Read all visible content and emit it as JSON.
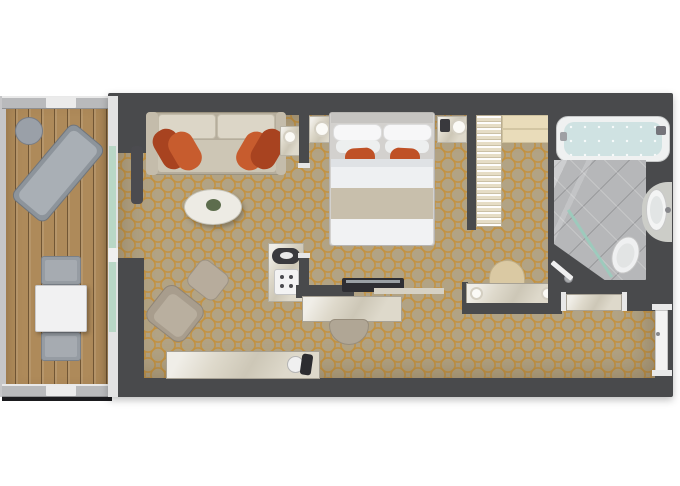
{
  "canvas": {
    "width": 680,
    "height": 486,
    "background": "#ffffff"
  },
  "palette": {
    "wall": "#494a4c",
    "carpet_base": "#b2a384",
    "carpet_lattice": "#c4913c",
    "deck_wood": "#ae8a5a",
    "marble": "#ded9cb",
    "accent_orange_dark": "#a84320",
    "accent_orange_light": "#c75c2e",
    "glass_green": "#b9d7c6",
    "bath_tile": "#b6b7b9",
    "tub_water": "#cfe2e2",
    "linen_white": "#f1f2f3"
  },
  "rooms": [
    {
      "name": "balcony"
    },
    {
      "name": "living-room"
    },
    {
      "name": "bedroom"
    },
    {
      "name": "closet"
    },
    {
      "name": "vanity-corridor"
    },
    {
      "name": "bathroom"
    },
    {
      "name": "entry"
    }
  ],
  "elements": [
    {
      "name": "balcony-deck",
      "cls": "deck",
      "x": 2,
      "y": 96,
      "w": 108,
      "h": 301
    },
    {
      "name": "balcony-left-rail",
      "x": 0,
      "y": 96,
      "w": 6,
      "h": 301,
      "fill": "#c6c6c8"
    },
    {
      "name": "balcony-top-rail",
      "cls": "rail",
      "x": 2,
      "y": 96,
      "w": 108,
      "h": 13
    },
    {
      "name": "balcony-top-rail-panel",
      "x": 46,
      "y": 97,
      "w": 30,
      "h": 11,
      "fill": "#ebebeb",
      "radius": 1
    },
    {
      "name": "balcony-bottom-rail",
      "cls": "rail",
      "x": 2,
      "y": 384,
      "w": 108,
      "h": 13
    },
    {
      "name": "balcony-bottom-rail-panel",
      "x": 46,
      "y": 385,
      "w": 30,
      "h": 11,
      "fill": "#ebebeb",
      "radius": 1
    },
    {
      "name": "balcony-shadow",
      "x": 2,
      "y": 397,
      "w": 110,
      "h": 4,
      "fill": "#1b1b1e"
    },
    {
      "name": "balcony-side-table",
      "x": 15,
      "y": 117,
      "w": 28,
      "h": 28,
      "fill": "#9aa0a8",
      "radius": "50%",
      "border": "1px solid #787d86"
    },
    {
      "name": "lounger-frame",
      "x": 36,
      "y": 124,
      "w": 44,
      "h": 98,
      "fill": "#8d949b",
      "radius": 8,
      "rotate": 40,
      "border": "1px solid #6f757c"
    },
    {
      "name": "lounger-pad",
      "x": 41,
      "y": 129,
      "w": 34,
      "h": 88,
      "fill": "#a9afb5",
      "radius": 6,
      "rotate": 40
    },
    {
      "name": "dining-chair-top",
      "x": 41,
      "y": 256,
      "w": 40,
      "h": 29,
      "fill": "#969ca3",
      "radius": 3,
      "border": "1px solid #7a8088"
    },
    {
      "name": "dining-chair-top-pad",
      "x": 45,
      "y": 260,
      "w": 32,
      "h": 21,
      "fill": "#a6abb1",
      "radius": 2
    },
    {
      "name": "dining-chair-bottom",
      "x": 41,
      "y": 332,
      "w": 40,
      "h": 29,
      "fill": "#969ca3",
      "radius": 3,
      "border": "1px solid #7a8088"
    },
    {
      "name": "dining-chair-bottom-pad",
      "x": 45,
      "y": 336,
      "w": 32,
      "h": 21,
      "fill": "#a6abb1",
      "radius": 2
    },
    {
      "name": "dining-table",
      "x": 35,
      "y": 285,
      "w": 52,
      "h": 47,
      "fill": "#f1f1f2",
      "radius": 2,
      "border": "1px solid #c9c9cb",
      "shadow": "2px 2px 4px rgba(0,0,0,.3)"
    },
    {
      "name": "suite-walls",
      "x": 108,
      "y": 93,
      "w": 565,
      "h": 304,
      "fill": "#494a4c",
      "radius": 2,
      "shadow": "0 3px 8px rgba(0,0,0,.25)"
    },
    {
      "name": "carpet-floor",
      "cls": "carpet",
      "x": 118,
      "y": 115,
      "w": 537,
      "h": 263
    },
    {
      "name": "wall-top-left-chunk",
      "x": 118,
      "y": 115,
      "w": 29,
      "h": 38,
      "fill": "#494a4c"
    },
    {
      "name": "wall-bottom-left-chunk",
      "x": 118,
      "y": 258,
      "w": 26,
      "h": 120,
      "fill": "#494a4c"
    },
    {
      "name": "balcony-glass-frame",
      "x": 108,
      "y": 96,
      "w": 10,
      "h": 301,
      "fill": "#e3e3e3"
    },
    {
      "name": "balcony-glass-pane",
      "x": 109,
      "y": 146,
      "w": 7,
      "h": 186,
      "fill": "#b9d7c6"
    },
    {
      "name": "balcony-glass-mullion",
      "x": 108,
      "y": 248,
      "w": 10,
      "h": 14,
      "fill": "#efefef"
    },
    {
      "name": "curtain",
      "x": 131,
      "y": 146,
      "w": 12,
      "h": 58,
      "fill": "#4b4b4f",
      "radius": 4
    },
    {
      "name": "sofa-base",
      "x": 146,
      "y": 112,
      "w": 140,
      "h": 63,
      "fill": "#b5ad9c",
      "radius": 4,
      "border": "1px solid #9a927f"
    },
    {
      "name": "sofa-arm-left",
      "x": 146,
      "y": 112,
      "w": 12,
      "h": 63,
      "fill": "#c4bcab",
      "radius": 4
    },
    {
      "name": "sofa-arm-right",
      "x": 276,
      "y": 112,
      "w": 10,
      "h": 63,
      "fill": "#c4bcab",
      "radius": 4
    },
    {
      "name": "sofa-back-cushion-left",
      "x": 158,
      "y": 114,
      "w": 58,
      "h": 25,
      "fill": "#dcd6c7",
      "radius": 4,
      "border": "1px solid #c2bba9"
    },
    {
      "name": "sofa-back-cushion-right",
      "x": 217,
      "y": 114,
      "w": 58,
      "h": 25,
      "fill": "#dcd6c7",
      "radius": 4,
      "border": "1px solid #c2bba9"
    },
    {
      "name": "sofa-seat",
      "x": 158,
      "y": 140,
      "w": 118,
      "h": 32,
      "fill": "#cdc6b5",
      "radius": 3
    },
    {
      "name": "sofa-pillow-dark-left",
      "x": 157,
      "y": 128,
      "w": 26,
      "h": 42,
      "fill": "#a84320",
      "radius": 12,
      "rotate": -30
    },
    {
      "name": "sofa-pillow-light-left",
      "x": 172,
      "y": 131,
      "w": 26,
      "h": 40,
      "fill": "#c75c2e",
      "radius": 12,
      "rotate": -30
    },
    {
      "name": "sofa-pillow-light-right",
      "x": 240,
      "y": 131,
      "w": 26,
      "h": 40,
      "fill": "#c75c2e",
      "radius": 12,
      "rotate": 30
    },
    {
      "name": "sofa-pillow-dark-right",
      "x": 255,
      "y": 128,
      "w": 26,
      "h": 42,
      "fill": "#a84320",
      "radius": 12,
      "rotate": 30
    },
    {
      "name": "sofa-side-table",
      "cls": "marble",
      "x": 280,
      "y": 126,
      "w": 20,
      "h": 30,
      "border": "1px solid #b9b4a6"
    },
    {
      "name": "sofa-side-lamp",
      "x": 283,
      "y": 130,
      "w": 14,
      "h": 14,
      "fill": "#fbfaf6",
      "radius": "50%",
      "border": "2px solid #d4cfc2"
    },
    {
      "name": "coffee-table",
      "x": 184,
      "y": 189,
      "w": 58,
      "h": 36,
      "fill": "#edebe4",
      "radius": "50%",
      "border": "1px solid #c6c4ba",
      "shadow": "2px 3px 4px rgba(60,50,30,.35)"
    },
    {
      "name": "coffee-table-plant",
      "x": 206,
      "y": 199,
      "w": 15,
      "h": 12,
      "fill": "#5d6d4d",
      "radius": "50%"
    },
    {
      "name": "armchair-ottoman",
      "x": 190,
      "y": 264,
      "w": 36,
      "h": 32,
      "fill": "#b7ac9c",
      "radius": 8,
      "rotate": 38,
      "border": "1px solid #9c9283"
    },
    {
      "name": "armchair",
      "x": 151,
      "y": 291,
      "w": 48,
      "h": 45,
      "fill": "#a89d8d",
      "radius": 10,
      "rotate": 38,
      "border": "1px solid #8f8577"
    },
    {
      "name": "armchair-cushion",
      "x": 158,
      "y": 299,
      "w": 35,
      "h": 33,
      "fill": "#b9af9f",
      "radius": 6,
      "rotate": 38
    },
    {
      "name": "minibar-cabinet",
      "cls": "marble",
      "x": 268,
      "y": 243,
      "w": 36,
      "h": 59,
      "border": "1px solid #b3ae9f"
    },
    {
      "name": "kettle",
      "x": 272,
      "y": 248,
      "w": 28,
      "h": 16,
      "fill": "#3a3a3e",
      "radius": 8
    },
    {
      "name": "kettle-lid",
      "x": 280,
      "y": 252,
      "w": 13,
      "h": 7,
      "fill": "#e9e9e9",
      "radius": "50%"
    },
    {
      "name": "espresso-machine",
      "x": 274,
      "y": 269,
      "w": 25,
      "h": 26,
      "fill": "#f3f3f3",
      "radius": 3,
      "border": "1px solid #c6c6c6"
    },
    {
      "name": "espresso-dot-1",
      "x": 280,
      "y": 275,
      "w": 4,
      "h": 4,
      "fill": "#4a4a4e",
      "radius": "50%"
    },
    {
      "name": "espresso-dot-2",
      "x": 289,
      "y": 275,
      "w": 4,
      "h": 4,
      "fill": "#4a4a4e",
      "radius": "50%"
    },
    {
      "name": "espresso-dot-3",
      "x": 280,
      "y": 284,
      "w": 4,
      "h": 4,
      "fill": "#4a4a4e",
      "radius": "50%"
    },
    {
      "name": "espresso-dot-4",
      "x": 289,
      "y": 284,
      "w": 4,
      "h": 4,
      "fill": "#4a4a4e",
      "radius": "50%"
    },
    {
      "name": "sideboard",
      "cls": "marble",
      "x": 166,
      "y": 351,
      "w": 154,
      "h": 28,
      "border": "1px solid #a8a295"
    },
    {
      "name": "ice-bucket",
      "x": 287,
      "y": 356,
      "w": 17,
      "h": 17,
      "fill": "#f0f0f0",
      "radius": "50%",
      "border": "1px solid #b5b5b5"
    },
    {
      "name": "wine-bottle",
      "x": 301,
      "y": 354,
      "w": 11,
      "h": 21,
      "fill": "#2c2c30",
      "radius": 3,
      "rotate": 8
    },
    {
      "name": "partition-upper",
      "x": 299,
      "y": 115,
      "w": 10,
      "h": 48,
      "fill": "#494a4c"
    },
    {
      "name": "bedroom-door-jamb-top",
      "x": 298,
      "y": 163,
      "w": 12,
      "h": 5,
      "fill": "#e6e6e6"
    },
    {
      "name": "bedroom-door-jamb-bottom",
      "x": 298,
      "y": 253,
      "w": 12,
      "h": 5,
      "fill": "#e6e6e6"
    },
    {
      "name": "partition-lower",
      "x": 299,
      "y": 258,
      "w": 10,
      "h": 40,
      "fill": "#494a4c"
    },
    {
      "name": "nightstand-left",
      "cls": "marble",
      "x": 309,
      "y": 116,
      "w": 27,
      "h": 27,
      "border": "1px solid #b9b4a6"
    },
    {
      "name": "nightstand-left-lamp",
      "x": 314,
      "y": 121,
      "w": 16,
      "h": 16,
      "fill": "#fbfaf6",
      "radius": "50%",
      "border": "2px solid #d4cfc2"
    },
    {
      "name": "nightstand-right",
      "cls": "marble",
      "x": 437,
      "y": 116,
      "w": 30,
      "h": 27,
      "border": "1px solid #b9b4a6"
    },
    {
      "name": "nightstand-phone",
      "x": 440,
      "y": 119,
      "w": 10,
      "h": 13,
      "fill": "#39393d",
      "radius": 2
    },
    {
      "name": "nightstand-right-lamp",
      "x": 451,
      "y": 119,
      "w": 16,
      "h": 16,
      "fill": "#fbfaf6",
      "radius": "50%",
      "border": "2px solid #d4cfc2"
    },
    {
      "name": "bed-frame",
      "x": 329,
      "y": 112,
      "w": 106,
      "h": 134,
      "fill": "#d3d1ce",
      "radius": 3,
      "border": "1px solid #b7b5b2"
    },
    {
      "name": "bed-headboard",
      "x": 331,
      "y": 113,
      "w": 102,
      "h": 10,
      "fill": "#c6c4c1"
    },
    {
      "name": "bed-pillow-back-left",
      "x": 333,
      "y": 124,
      "w": 49,
      "h": 17,
      "fill": "#f7f7f8",
      "radius": 7,
      "border": "1px solid #dcdcdc"
    },
    {
      "name": "bed-pillow-back-right",
      "x": 383,
      "y": 124,
      "w": 49,
      "h": 17,
      "fill": "#f7f7f8",
      "radius": 7,
      "border": "1px solid #dcdcdc"
    },
    {
      "name": "bed-pillow-front-left",
      "x": 336,
      "y": 140,
      "w": 44,
      "h": 13,
      "fill": "#edefef",
      "radius": 6
    },
    {
      "name": "bed-pillow-front-right",
      "x": 385,
      "y": 140,
      "w": 44,
      "h": 13,
      "fill": "#edefef",
      "radius": 6
    },
    {
      "name": "bed-orange-pillow-left",
      "x": 345,
      "y": 148,
      "w": 30,
      "h": 19,
      "fill": "#bf5126",
      "radius": 9,
      "rotate": -3
    },
    {
      "name": "bed-orange-pillow-right",
      "x": 390,
      "y": 148,
      "w": 30,
      "h": 19,
      "fill": "#bf5126",
      "radius": 9,
      "rotate": 3
    },
    {
      "name": "bed-duvet",
      "x": 331,
      "y": 159,
      "w": 102,
      "h": 62,
      "fill": "#eef0f2"
    },
    {
      "name": "bed-duvet-fold",
      "x": 331,
      "y": 159,
      "w": 102,
      "h": 8,
      "fill": "#dfe2e5"
    },
    {
      "name": "bed-runner",
      "x": 331,
      "y": 188,
      "w": 102,
      "h": 31,
      "fill": "#c8bfac"
    },
    {
      "name": "bed-foot-throw",
      "x": 331,
      "y": 219,
      "w": 102,
      "h": 26,
      "fill": "#f1f2f3",
      "radius": "0 0 3px 3px"
    },
    {
      "name": "tv-partition-wall",
      "x": 296,
      "y": 285,
      "w": 58,
      "h": 13,
      "fill": "#494a4c"
    },
    {
      "name": "tv-unit",
      "x": 342,
      "y": 278,
      "w": 62,
      "h": 14,
      "fill": "#2e2e33",
      "radius": 2
    },
    {
      "name": "tv-screen",
      "x": 346,
      "y": 280,
      "w": 54,
      "h": 3,
      "fill": "#9aa0a5"
    },
    {
      "name": "media-shelf",
      "x": 374,
      "y": 288,
      "w": 70,
      "h": 6,
      "fill": "#d6d1c4"
    },
    {
      "name": "desk",
      "cls": "marble",
      "x": 302,
      "y": 296,
      "w": 100,
      "h": 26,
      "border": "1px solid #a8a295"
    },
    {
      "name": "desk-stool",
      "x": 329,
      "y": 319,
      "w": 40,
      "h": 26,
      "fill": "#b0a695",
      "radius": "6px 6px 20px 20px",
      "border": "1px solid #978d7c"
    },
    {
      "name": "closet-wall-left",
      "x": 467,
      "y": 115,
      "w": 9,
      "h": 115,
      "fill": "#494a4c"
    },
    {
      "name": "closet-hanging-rail",
      "cls": "hangers",
      "x": 476,
      "y": 115,
      "w": 26,
      "h": 112,
      "border": "1px solid #b9ad92"
    },
    {
      "name": "closet-cabinet",
      "x": 502,
      "y": 115,
      "w": 48,
      "h": 28,
      "fill": "#e9dcba",
      "border": "1px solid #cec19e"
    },
    {
      "name": "closet-cabinet-seam",
      "x": 502,
      "y": 128,
      "w": 48,
      "h": 2,
      "fill": "#d3c6a3"
    },
    {
      "name": "vanity-stool",
      "x": 489,
      "y": 260,
      "w": 36,
      "h": 25,
      "fill": "#dac9a3",
      "radius": "18px 18px 3px 3px",
      "border": "1px solid #bfae88"
    },
    {
      "name": "vanity-wall-left",
      "x": 462,
      "y": 282,
      "w": 6,
      "h": 32,
      "fill": "#494a4c"
    },
    {
      "name": "vanity-counter",
      "cls": "marble",
      "x": 466,
      "y": 283,
      "w": 92,
      "h": 22,
      "border": "1px solid #a8a295"
    },
    {
      "name": "vanity-lamp-left",
      "x": 470,
      "y": 287,
      "w": 13,
      "h": 13,
      "fill": "#fbfaf6",
      "radius": "50%",
      "border": "2px solid #d4cfc2"
    },
    {
      "name": "vanity-lamp-right",
      "x": 541,
      "y": 287,
      "w": 13,
      "h": 13,
      "fill": "#fbfaf6",
      "radius": "50%",
      "border": "2px solid #d4cfc2"
    },
    {
      "name": "vanity-wall-bottom",
      "x": 462,
      "y": 303,
      "w": 100,
      "h": 11,
      "fill": "#494a4c"
    },
    {
      "name": "bathroom-zone",
      "x": 548,
      "y": 115,
      "w": 125,
      "h": 196,
      "fill": "#494a4c"
    },
    {
      "name": "bathtub",
      "x": 556,
      "y": 116,
      "w": 114,
      "h": 46,
      "fill": "#eff1f1",
      "radius": 12,
      "border": "1px solid #c6c8c8"
    },
    {
      "name": "bathtub-water",
      "cls": "water",
      "x": 564,
      "y": 122,
      "w": 98,
      "h": 34,
      "radius": 10
    },
    {
      "name": "bathtub-faucet",
      "x": 656,
      "y": 126,
      "w": 10,
      "h": 9,
      "fill": "#74747a",
      "radius": 2
    },
    {
      "name": "bathtub-handle",
      "x": 560,
      "y": 132,
      "w": 7,
      "h": 9,
      "fill": "#9fa0a4",
      "radius": 2
    },
    {
      "name": "bathroom-floor",
      "cls": "tile",
      "x": 554,
      "y": 160,
      "w": 92,
      "h": 120,
      "clip": "polygon(0 0, 100% 0, 100% 100%, 55% 100%, 0 70%)"
    },
    {
      "name": "sink-counter",
      "x": 642,
      "y": 182,
      "w": 30,
      "h": 60,
      "fill": "#cccdc8",
      "radius": "26px 0 0 26px"
    },
    {
      "name": "sink",
      "x": 646,
      "y": 189,
      "w": 21,
      "h": 42,
      "fill": "#f3f4f4",
      "radius": "50%",
      "border": "1px solid #c8c8c8"
    },
    {
      "name": "sink-basin",
      "x": 650,
      "y": 196,
      "w": 13,
      "h": 28,
      "fill": "#e2e5e5",
      "radius": "50%"
    },
    {
      "name": "sink-faucet",
      "x": 665,
      "y": 207,
      "w": 6,
      "h": 6,
      "fill": "#85868a",
      "radius": "50%"
    },
    {
      "name": "toilet",
      "x": 612,
      "y": 236,
      "w": 27,
      "h": 38,
      "fill": "#eff0f1",
      "radius": "50%",
      "rotate": 18,
      "border": "1px solid #c5c5c5"
    },
    {
      "name": "toilet-seat",
      "x": 617,
      "y": 243,
      "w": 17,
      "h": 25,
      "fill": "#e2e4e4",
      "radius": "50%",
      "rotate": 18
    },
    {
      "name": "shower-glass",
      "x": 550,
      "y": 242,
      "w": 80,
      "h": 3,
      "fill": "#9accbc",
      "rotate": 57,
      "opacity": 0.9
    },
    {
      "name": "shower-drain",
      "x": 564,
      "y": 274,
      "w": 9,
      "h": 9,
      "fill": "#a9abad",
      "radius": "50%",
      "border": "1px solid #8e8f93"
    },
    {
      "name": "bathroom-door",
      "x": 549,
      "y": 268,
      "w": 26,
      "h": 5,
      "fill": "#f0f0f0",
      "rotate": 40,
      "radius": 1
    },
    {
      "name": "hall-console-jamb-left",
      "x": 561,
      "y": 292,
      "w": 5,
      "h": 19,
      "fill": "#e8e8e8"
    },
    {
      "name": "hall-console-jamb-right",
      "x": 622,
      "y": 292,
      "w": 5,
      "h": 19,
      "fill": "#e8e8e8"
    },
    {
      "name": "hall-console",
      "cls": "marble",
      "x": 566,
      "y": 294,
      "w": 56,
      "h": 17,
      "border": "1px solid #a8a295"
    },
    {
      "name": "entry-door-jamb-top",
      "x": 652,
      "y": 304,
      "w": 20,
      "h": 6,
      "fill": "#e9e9e9"
    },
    {
      "name": "entry-door",
      "x": 655,
      "y": 310,
      "w": 13,
      "h": 62,
      "fill": "#f3f3f3",
      "radius": 1,
      "border": "1px solid #c6c6c6"
    },
    {
      "name": "entry-door-handle",
      "x": 656,
      "y": 332,
      "w": 4,
      "h": 4,
      "fill": "#88898d",
      "radius": "50%"
    },
    {
      "name": "entry-door-jamb-bottom",
      "x": 652,
      "y": 370,
      "w": 20,
      "h": 6,
      "fill": "#e9e9e9"
    }
  ]
}
